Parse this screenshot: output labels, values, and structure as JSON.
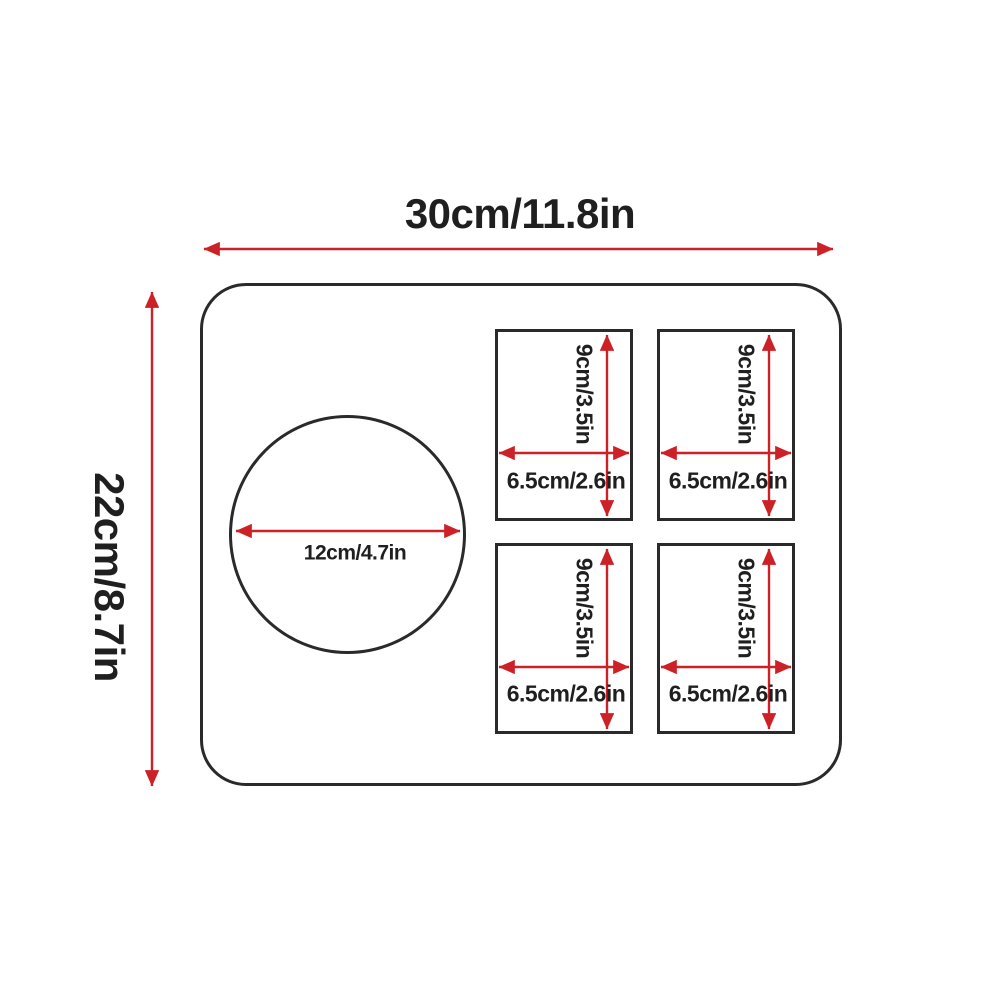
{
  "diagram": {
    "overall": {
      "width_label": "30cm/11.8in",
      "height_label": "22cm/8.7in"
    },
    "circle": {
      "diameter_label": "12cm/4.7in"
    },
    "rects": [
      {
        "name": "top-left",
        "width_label": "6.5cm/2.6in",
        "height_label": "9cm/3.5in"
      },
      {
        "name": "top-right",
        "width_label": "6.5cm/2.6in",
        "height_label": "9cm/3.5in"
      },
      {
        "name": "bottom-left",
        "width_label": "6.5cm/2.6in",
        "height_label": "9cm/3.5in"
      },
      {
        "name": "bottom-right",
        "width_label": "6.5cm/2.6in",
        "height_label": "9cm/3.5in"
      }
    ],
    "colors": {
      "arrow": "#cc2127",
      "outline": "#2a2a2a",
      "text": "#1f1f1f",
      "background": "#ffffff"
    }
  }
}
